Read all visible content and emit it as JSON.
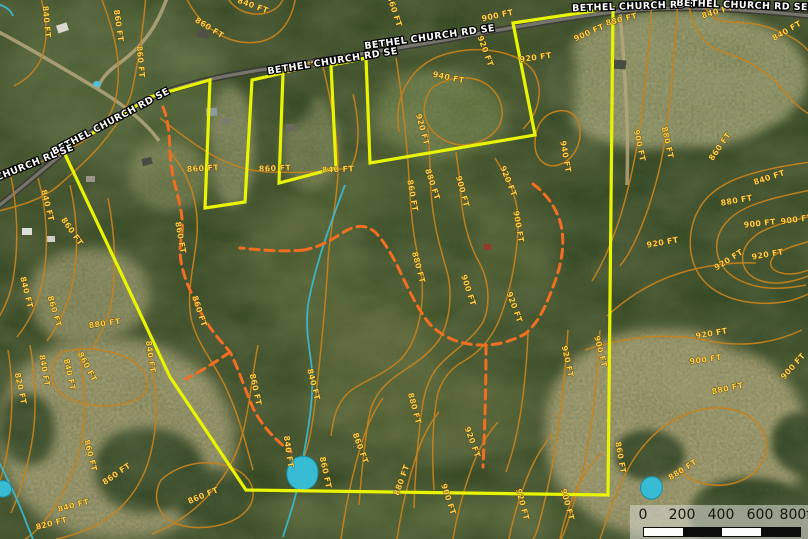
{
  "map": {
    "colors": {
      "boundary": "#e9f402",
      "contour": "#c5821c",
      "contour_label": "#ffd24a",
      "trail": "#f26f22",
      "water": "#38bcd4",
      "road_label": "#ffffff"
    },
    "road_labels": [
      {
        "t": "BETHEL CHURCH RD SE",
        "x": 112,
        "y": 124,
        "r": -28
      },
      {
        "t": "HEL CHURCH RL SE",
        "x": 24,
        "y": 170,
        "r": -22
      },
      {
        "t": "BETHEL CHURCH RD SE",
        "x": 333,
        "y": 64,
        "r": -9
      },
      {
        "t": "BETHEL CHURCH RD SE",
        "x": 430,
        "y": 40,
        "r": -8
      },
      {
        "t": "BETHEL CHURCH RD SE",
        "x": 638,
        "y": 9,
        "r": -2
      },
      {
        "t": "BETHEL CHURCH RD SE",
        "x": 742,
        "y": 8,
        "r": 2
      }
    ],
    "contour_labels": [
      {
        "t": "840 FT",
        "x": 44,
        "y": 22,
        "r": 85
      },
      {
        "t": "860 FT",
        "x": 116,
        "y": 26,
        "r": 82
      },
      {
        "t": "860 FT",
        "x": 138,
        "y": 62,
        "r": 85
      },
      {
        "t": "860 FT",
        "x": 208,
        "y": 30,
        "r": 32
      },
      {
        "t": "840 FT",
        "x": 252,
        "y": 8,
        "r": 20
      },
      {
        "t": "860 FT",
        "x": 302,
        "y": 70,
        "r": -14
      },
      {
        "t": "860 FT",
        "x": 392,
        "y": 12,
        "r": 72
      },
      {
        "t": "900 FT",
        "x": 498,
        "y": 18,
        "r": -12
      },
      {
        "t": "900 FT",
        "x": 590,
        "y": 35,
        "r": -24
      },
      {
        "t": "880 FT",
        "x": 622,
        "y": 22,
        "r": -14
      },
      {
        "t": "840 FT",
        "x": 718,
        "y": 14,
        "r": -16
      },
      {
        "t": "840 FT",
        "x": 788,
        "y": 33,
        "r": -30
      },
      {
        "t": "920 FT",
        "x": 536,
        "y": 60,
        "r": -8
      },
      {
        "t": "940 FT",
        "x": 448,
        "y": 80,
        "r": 12
      },
      {
        "t": "920 FT",
        "x": 420,
        "y": 130,
        "r": 75
      },
      {
        "t": "920 FT",
        "x": 483,
        "y": 52,
        "r": 70
      },
      {
        "t": "940 FT",
        "x": 563,
        "y": 157,
        "r": 80
      },
      {
        "t": "860 FT",
        "x": 203,
        "y": 171,
        "r": -3
      },
      {
        "t": "860 FT",
        "x": 275,
        "y": 171,
        "r": -2
      },
      {
        "t": "840 FT",
        "x": 338,
        "y": 172,
        "r": -2
      },
      {
        "t": "860 FT",
        "x": 410,
        "y": 196,
        "r": 80
      },
      {
        "t": "880 FT",
        "x": 430,
        "y": 185,
        "r": 72
      },
      {
        "t": "900 FT",
        "x": 460,
        "y": 192,
        "r": 75
      },
      {
        "t": "920 FT",
        "x": 506,
        "y": 182,
        "r": 68
      },
      {
        "t": "900 FT",
        "x": 516,
        "y": 227,
        "r": 80
      },
      {
        "t": "880 FT",
        "x": 416,
        "y": 268,
        "r": 75
      },
      {
        "t": "900 FT",
        "x": 466,
        "y": 291,
        "r": 72
      },
      {
        "t": "920 FT",
        "x": 512,
        "y": 308,
        "r": 70
      },
      {
        "t": "900 FT",
        "x": 637,
        "y": 146,
        "r": 78
      },
      {
        "t": "880 FT",
        "x": 665,
        "y": 143,
        "r": 78
      },
      {
        "t": "860 FT",
        "x": 722,
        "y": 148,
        "r": -55
      },
      {
        "t": "840 FT",
        "x": 770,
        "y": 180,
        "r": -18
      },
      {
        "t": "880 FT",
        "x": 737,
        "y": 203,
        "r": -10
      },
      {
        "t": "900 FT",
        "x": 760,
        "y": 226,
        "r": -6
      },
      {
        "t": "900 FT",
        "x": 797,
        "y": 222,
        "r": -8
      },
      {
        "t": "920 FT",
        "x": 663,
        "y": 245,
        "r": -10
      },
      {
        "t": "920 FT",
        "x": 730,
        "y": 262,
        "r": -32
      },
      {
        "t": "920 FT",
        "x": 768,
        "y": 257,
        "r": -10
      },
      {
        "t": "920 FT",
        "x": 565,
        "y": 362,
        "r": 78
      },
      {
        "t": "900 FT",
        "x": 598,
        "y": 352,
        "r": 76
      },
      {
        "t": "920 FT",
        "x": 712,
        "y": 336,
        "r": -10
      },
      {
        "t": "900 FT",
        "x": 706,
        "y": 362,
        "r": -8
      },
      {
        "t": "880 FT",
        "x": 728,
        "y": 391,
        "r": -12
      },
      {
        "t": "900 FT",
        "x": 795,
        "y": 368,
        "r": -48
      },
      {
        "t": "860 FT",
        "x": 618,
        "y": 458,
        "r": 80
      },
      {
        "t": "880 FT",
        "x": 684,
        "y": 472,
        "r": -32
      },
      {
        "t": "860 FT",
        "x": 253,
        "y": 390,
        "r": 78
      },
      {
        "t": "840 FT",
        "x": 311,
        "y": 385,
        "r": 76
      },
      {
        "t": "840 FT",
        "x": 286,
        "y": 452,
        "r": 82
      },
      {
        "t": "860 FT",
        "x": 323,
        "y": 473,
        "r": 78
      },
      {
        "t": "860 FT",
        "x": 358,
        "y": 449,
        "r": 70
      },
      {
        "t": "880 FT",
        "x": 412,
        "y": 409,
        "r": 75
      },
      {
        "t": "880 FT",
        "x": 404,
        "y": 481,
        "r": -70
      },
      {
        "t": "900 FT",
        "x": 446,
        "y": 500,
        "r": 72
      },
      {
        "t": "920 FT",
        "x": 470,
        "y": 443,
        "r": 70
      },
      {
        "t": "920 FT",
        "x": 520,
        "y": 505,
        "r": 75
      },
      {
        "t": "900 FT",
        "x": 565,
        "y": 505,
        "r": 75
      },
      {
        "t": "820 FT",
        "x": 18,
        "y": 389,
        "r": 78
      },
      {
        "t": "840 FT",
        "x": 42,
        "y": 371,
        "r": 80
      },
      {
        "t": "840 FT",
        "x": 67,
        "y": 375,
        "r": 78
      },
      {
        "t": "860 FT",
        "x": 85,
        "y": 368,
        "r": 62
      },
      {
        "t": "860 FT",
        "x": 88,
        "y": 456,
        "r": 76
      },
      {
        "t": "840 FT",
        "x": 148,
        "y": 357,
        "r": 82
      },
      {
        "t": "860 FT",
        "x": 118,
        "y": 476,
        "r": -35
      },
      {
        "t": "840 FT",
        "x": 74,
        "y": 508,
        "r": -14
      },
      {
        "t": "820 FT",
        "x": 52,
        "y": 526,
        "r": -14
      },
      {
        "t": "860 FT",
        "x": 204,
        "y": 498,
        "r": -22
      },
      {
        "t": "840 FT",
        "x": 45,
        "y": 206,
        "r": 76
      },
      {
        "t": "860 FT",
        "x": 70,
        "y": 233,
        "r": 55
      },
      {
        "t": "840 FT",
        "x": 24,
        "y": 293,
        "r": 76
      },
      {
        "t": "860 FT",
        "x": 52,
        "y": 312,
        "r": 74
      },
      {
        "t": "880 FT",
        "x": 105,
        "y": 326,
        "r": -8
      },
      {
        "t": "860 FT",
        "x": 178,
        "y": 238,
        "r": 80
      },
      {
        "t": "860 FT",
        "x": 197,
        "y": 312,
        "r": 72
      }
    ],
    "scale_bar": {
      "ticks": [
        "0",
        "200",
        "400",
        "600",
        "800ft"
      ]
    }
  }
}
